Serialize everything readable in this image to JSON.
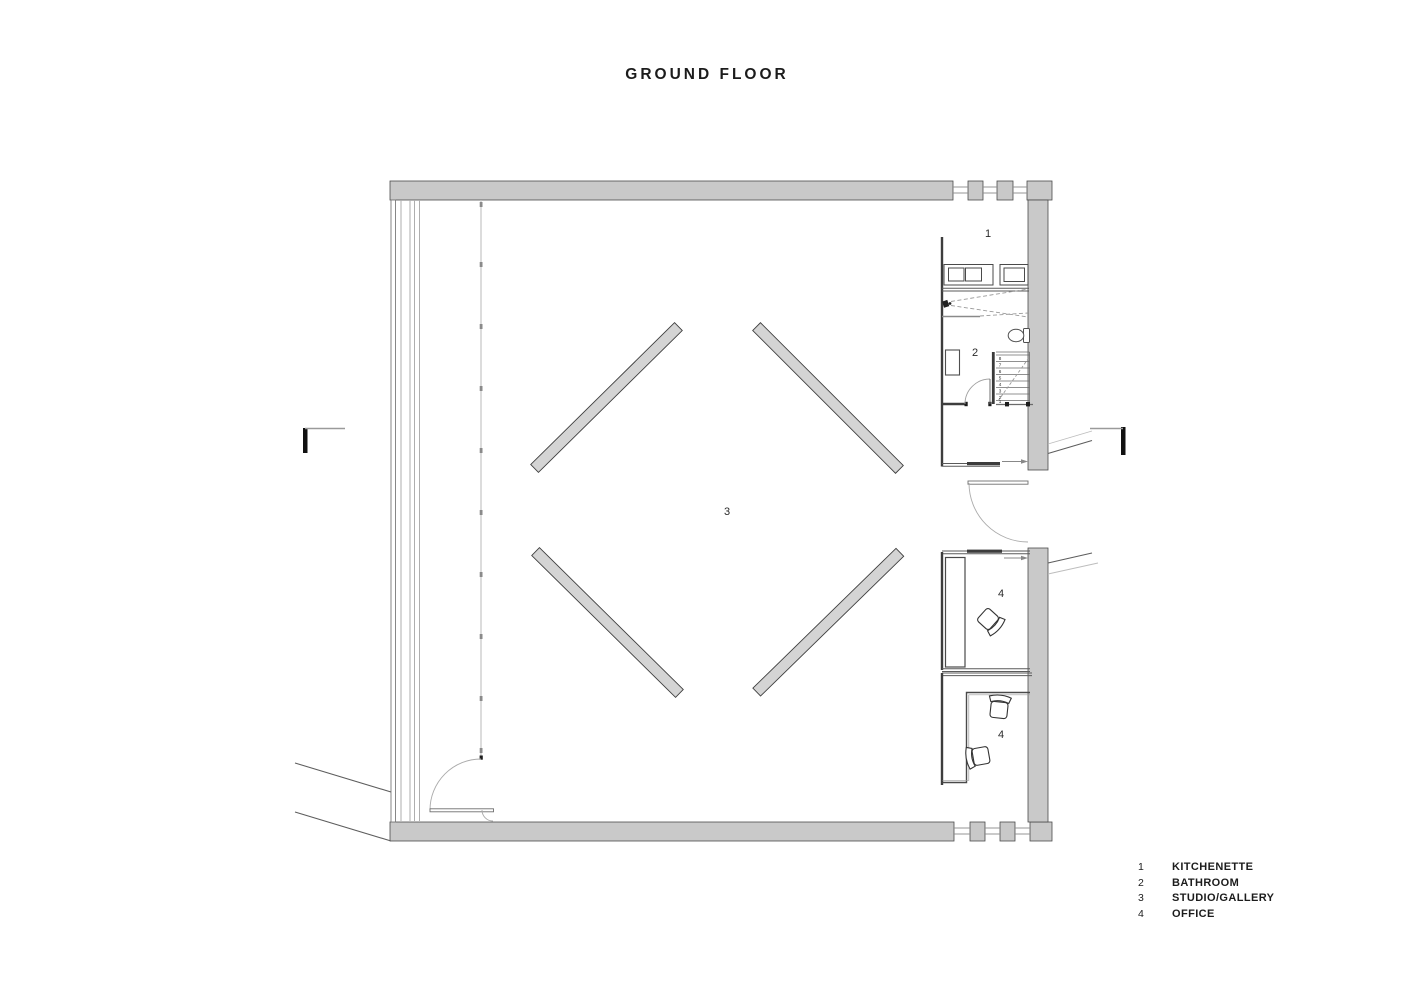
{
  "title": "GROUND FLOOR",
  "rooms": {
    "kitchenette": {
      "number": "1",
      "name": "KITCHENETTE"
    },
    "bathroom": {
      "number": "2",
      "name": "BATHROOM"
    },
    "studio": {
      "number": "3",
      "name": "STUDIO/GALLERY"
    },
    "office_upper": {
      "number": "4",
      "name": "OFFICE"
    },
    "office_lower": {
      "number": "4",
      "name": "OFFICE"
    }
  },
  "stairs": {
    "numbers": [
      "1",
      "2",
      "3",
      "4",
      "5",
      "6",
      "7",
      "8"
    ]
  },
  "legend": {
    "items": [
      {
        "num": "1",
        "label": "KITCHENETTE"
      },
      {
        "num": "2",
        "label": "BATHROOM"
      },
      {
        "num": "3",
        "label": "STUDIO/GALLERY"
      },
      {
        "num": "4",
        "label": "OFFICE"
      }
    ]
  },
  "colors": {
    "wall_fill": "#c9c9c9",
    "wall_stroke": "#4c4c4c",
    "partition": "#3d3d3d",
    "thin_line": "#6b6b6b",
    "light_line": "#b5b5b5",
    "text": "#1f1f1f"
  }
}
